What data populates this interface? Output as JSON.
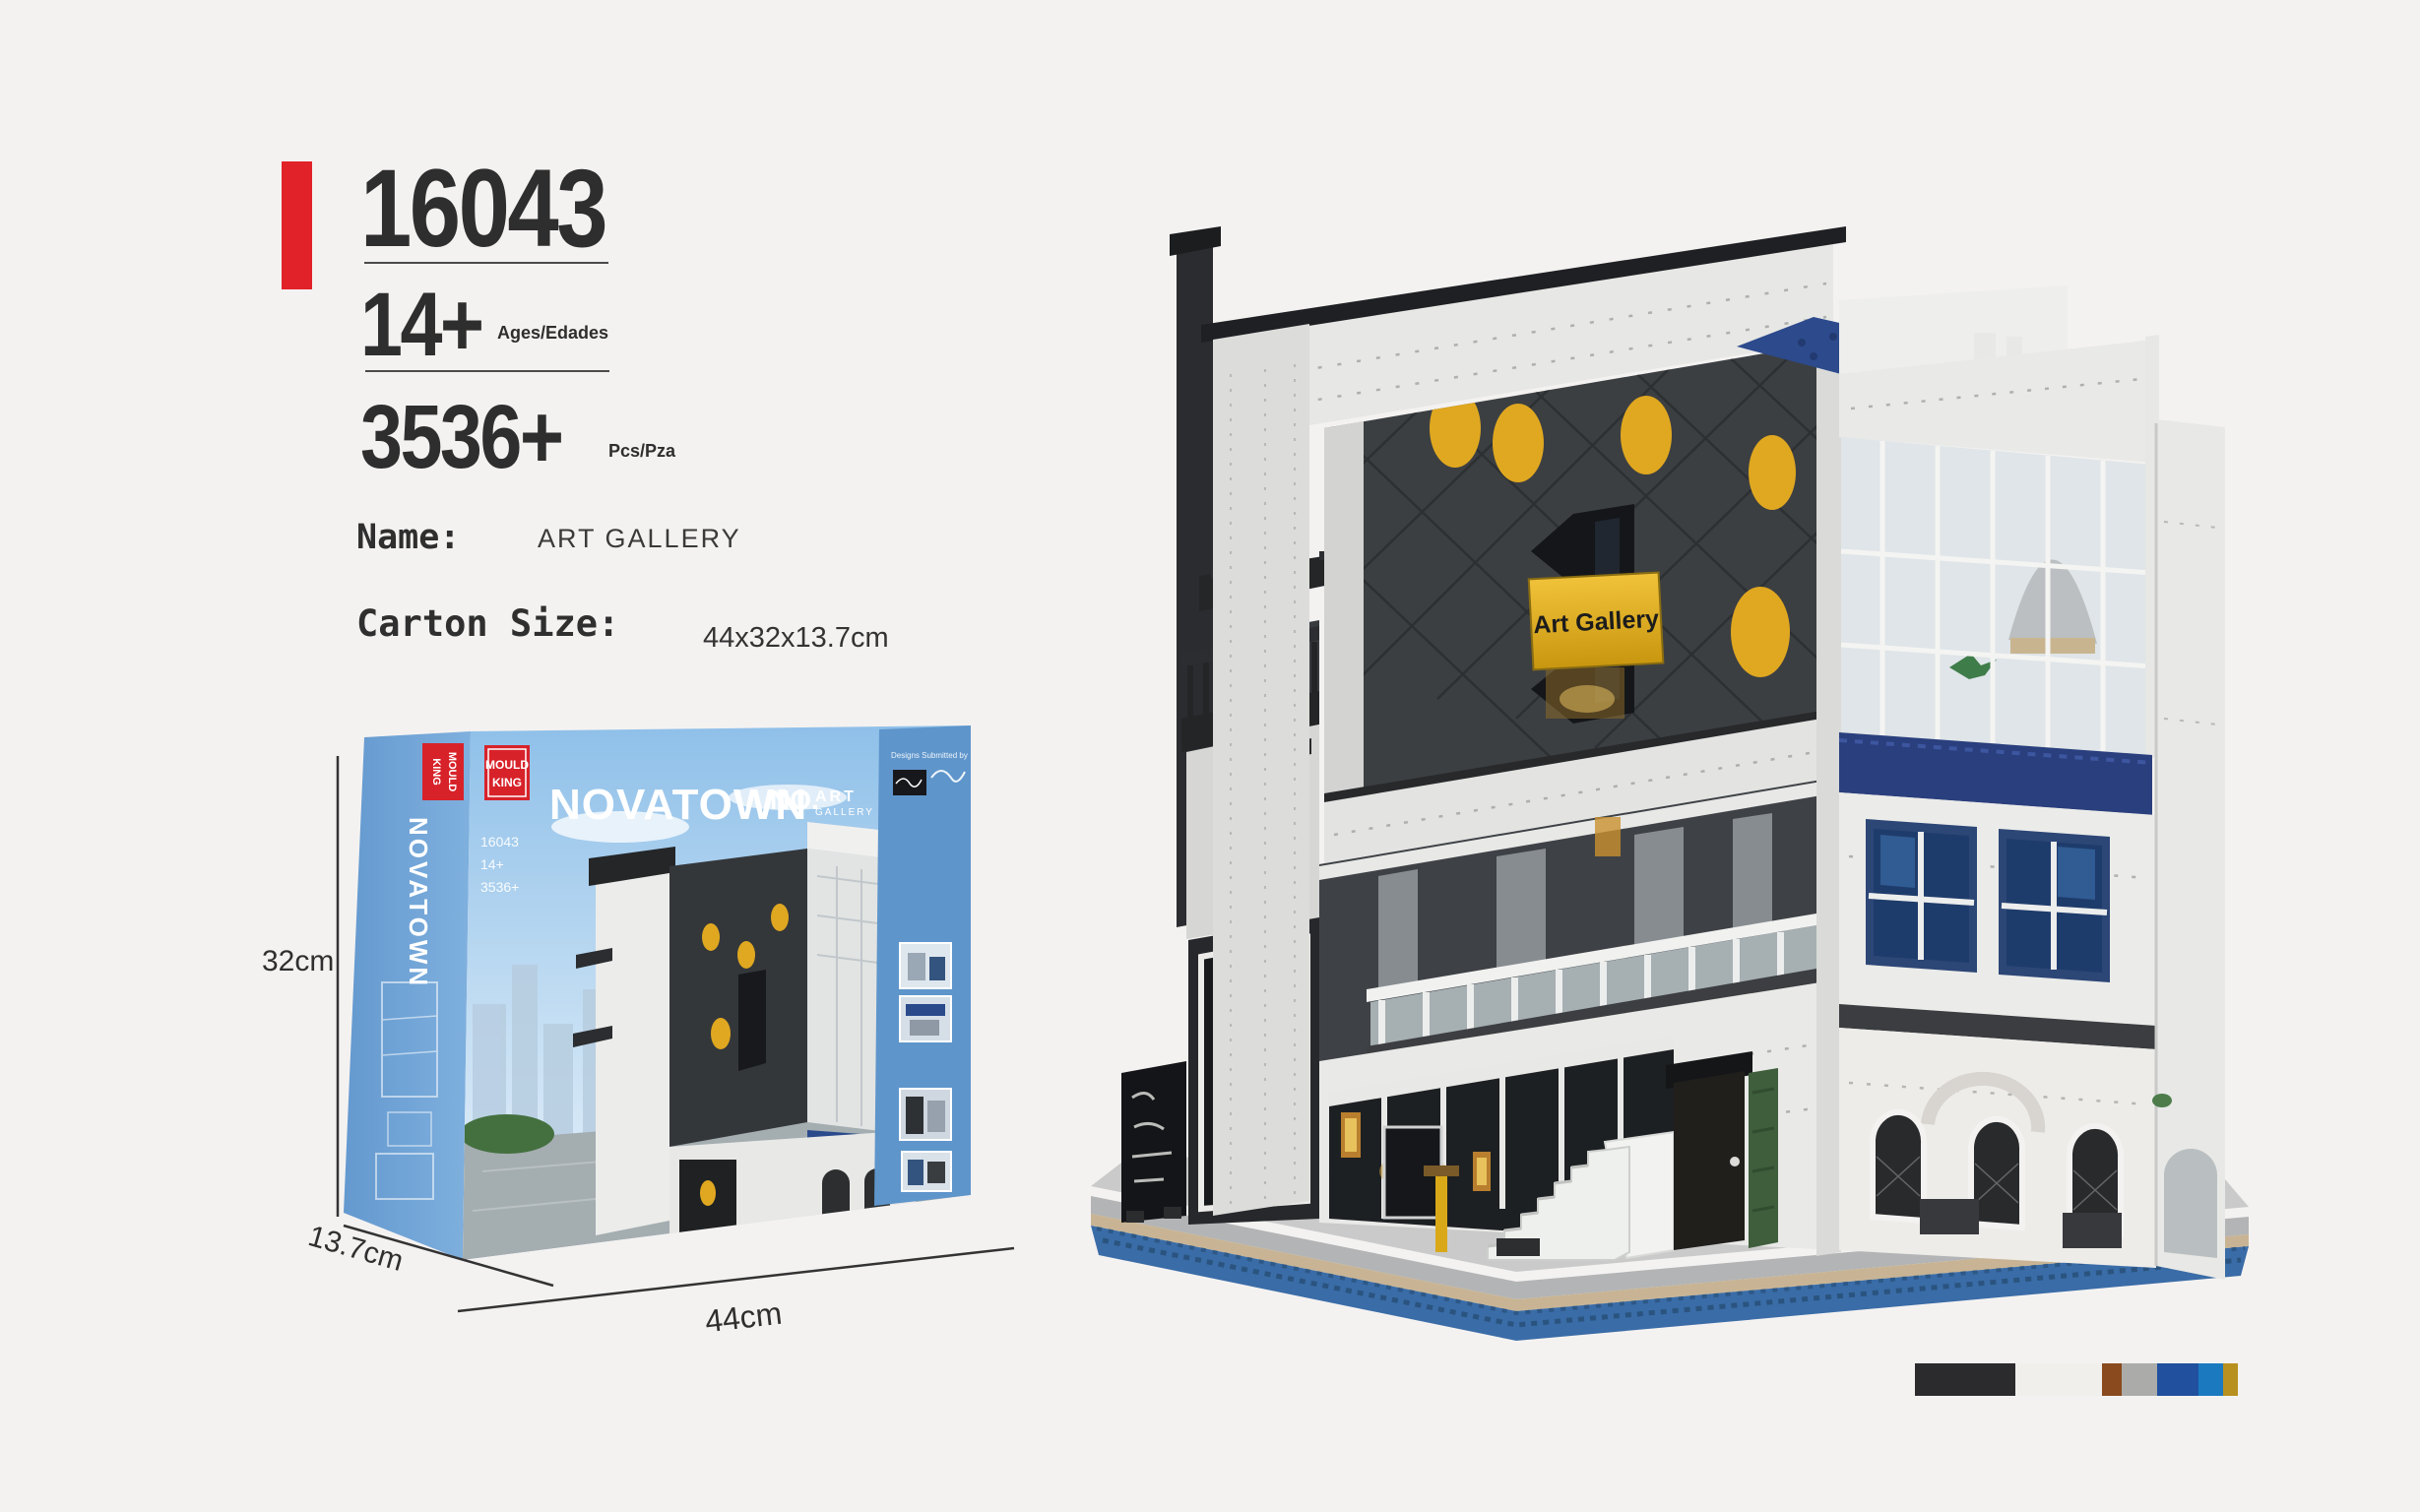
{
  "header": {
    "model_number": "16043",
    "age_value": "14+",
    "age_unit": "Ages/Edades",
    "pieces_value": "3536+",
    "pieces_unit": "Pcs/Pza",
    "name_label": "Name:",
    "name_value": "ART GALLERY",
    "carton_label": "Carton Size:",
    "carton_value": "44x32x13.7cm",
    "accent_color": "#e12228"
  },
  "box": {
    "brand_top": "MOULD",
    "brand_bottom": "KING",
    "series_logo": "NOVATOWN",
    "spine_vertical_text": "NOVATOWN",
    "set_logo_no": "NO.",
    "set_logo_art": "ART",
    "set_logo_gallery": "GALLERY",
    "designer_note": "Designs Submitted by",
    "front_number": "16043",
    "front_age": "14+",
    "front_pieces": "3536+"
  },
  "dimensions": {
    "height": "32cm",
    "width": "44cm",
    "depth": "13.7cm"
  },
  "model": {
    "sign_text": "Art Gallery"
  },
  "palette": {
    "colors": [
      {
        "name": "black",
        "hex": "#2b2b2d",
        "width": 102
      },
      {
        "name": "white",
        "hex": "#f0efeb",
        "width": 88
      },
      {
        "name": "brown",
        "hex": "#8a4a1d",
        "width": 20
      },
      {
        "name": "gray",
        "hex": "#ababa9",
        "width": 36
      },
      {
        "name": "dark-blue",
        "hex": "#20509e",
        "width": 42
      },
      {
        "name": "bright-blue",
        "hex": "#1b79c0",
        "width": 25
      },
      {
        "name": "gold",
        "hex": "#b8901f",
        "width": 15
      }
    ]
  }
}
